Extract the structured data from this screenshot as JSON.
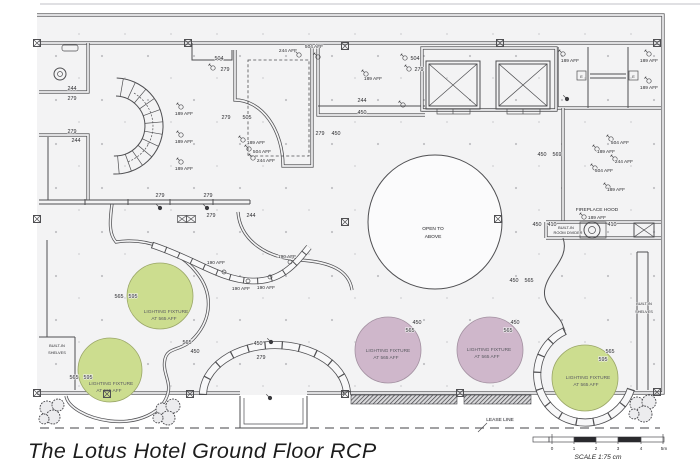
{
  "title": "The Lotus Hotel Ground Floor RCP",
  "colors": {
    "line": "#4f4f52",
    "planbg": "#f3f3f4",
    "green": "#ccdd8f",
    "purple": "#cfb7cb",
    "ink": "#1c1c1c"
  },
  "strings": {
    "d244": "244",
    "d279": "279",
    "d450": "450",
    "d504": "504",
    "d505": "505",
    "d410": "410",
    "d565": "565",
    "d569": "569",
    "d595": "595",
    "aff189": "189 AFF",
    "aff190": "190 AFF",
    "aff244": "244 AFF",
    "aff504": "504 AFF",
    "open1": "OPEN TO",
    "open2": "ABOVE",
    "fireplace": "FIREPLACE HOOD",
    "builtin": "BUILT-IN",
    "shelves": "SHELVES",
    "room_divider": "ROOM DIVIDER",
    "fixture1": "LIGHTING FIXTURE",
    "fixture2": "AT 565 AFF",
    "lease": "LEASE LINE",
    "e": "E"
  },
  "scale_bar": {
    "ticks": [
      "0",
      "1",
      "2",
      "3",
      "4",
      "5m"
    ],
    "caption": "SCALE 1:75 cm"
  }
}
